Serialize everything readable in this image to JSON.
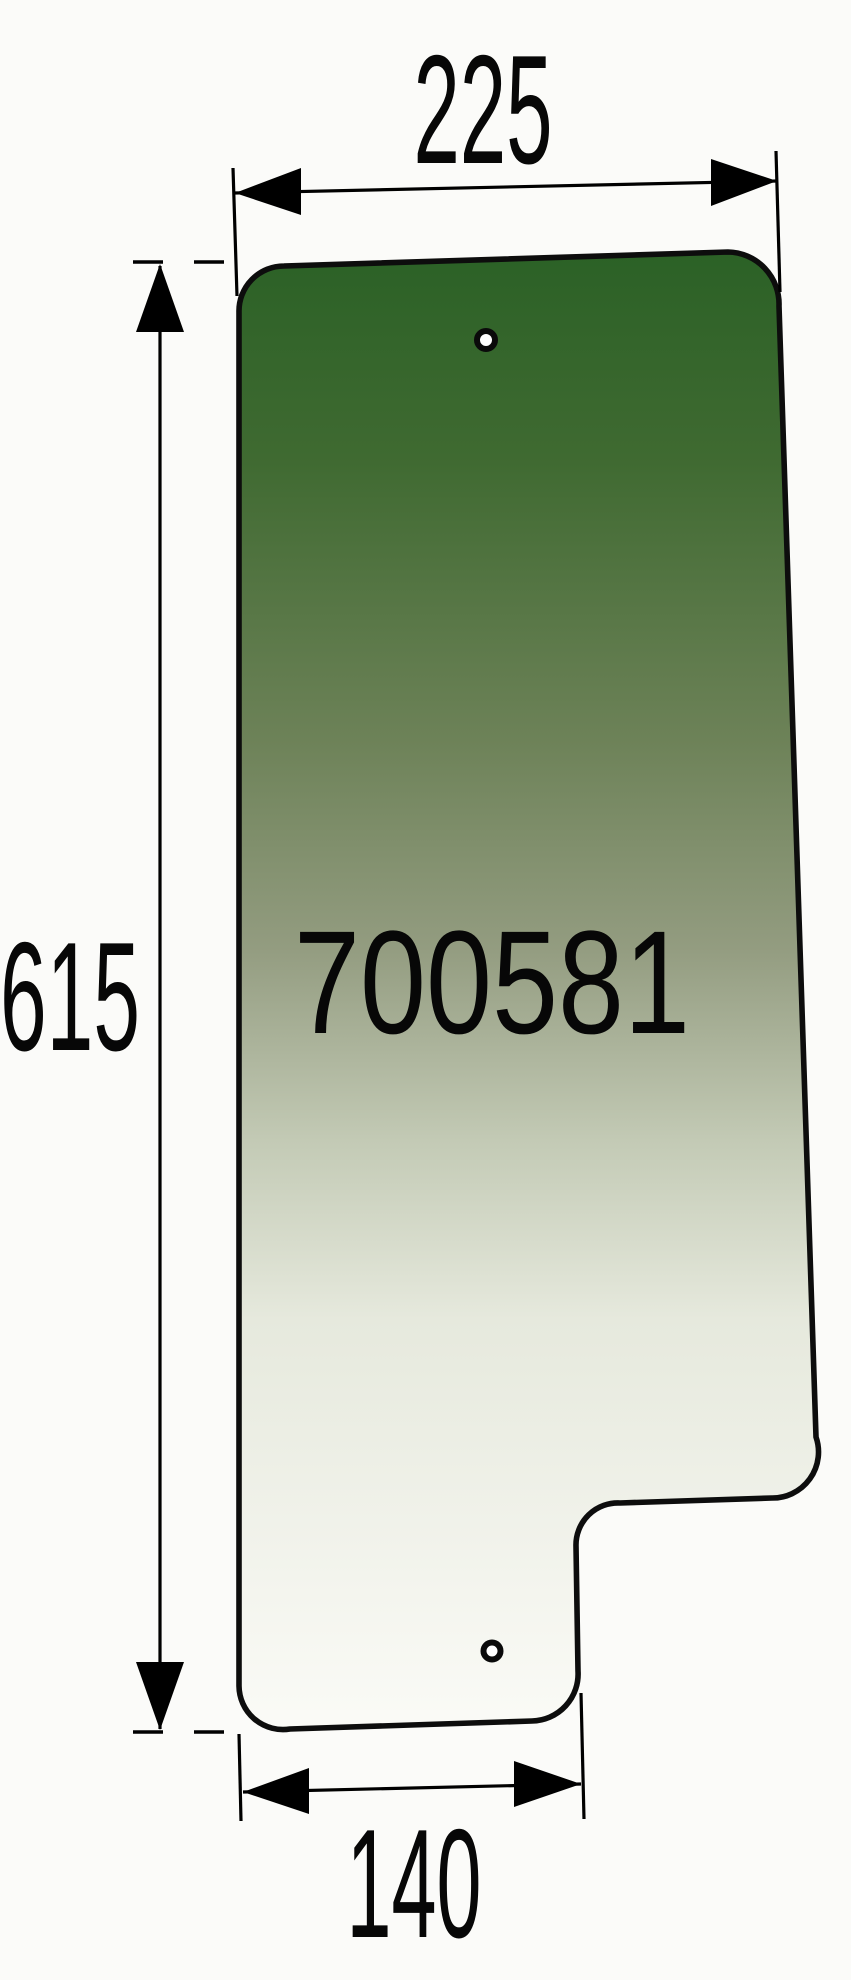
{
  "drawing": {
    "part_number": "700581",
    "dimensions": {
      "top_width": "225",
      "height": "615",
      "bottom_width": "140"
    },
    "glass": {
      "gradient_stops": [
        "#2b6126",
        "#3f6a31",
        "#6d8258",
        "#939c80",
        "#c3cab5",
        "#e6e9dd",
        "#fbfbf7"
      ],
      "outline_color": "#0d0d0d"
    },
    "line_color": "#000000",
    "background_color": "#fbfbf9"
  }
}
